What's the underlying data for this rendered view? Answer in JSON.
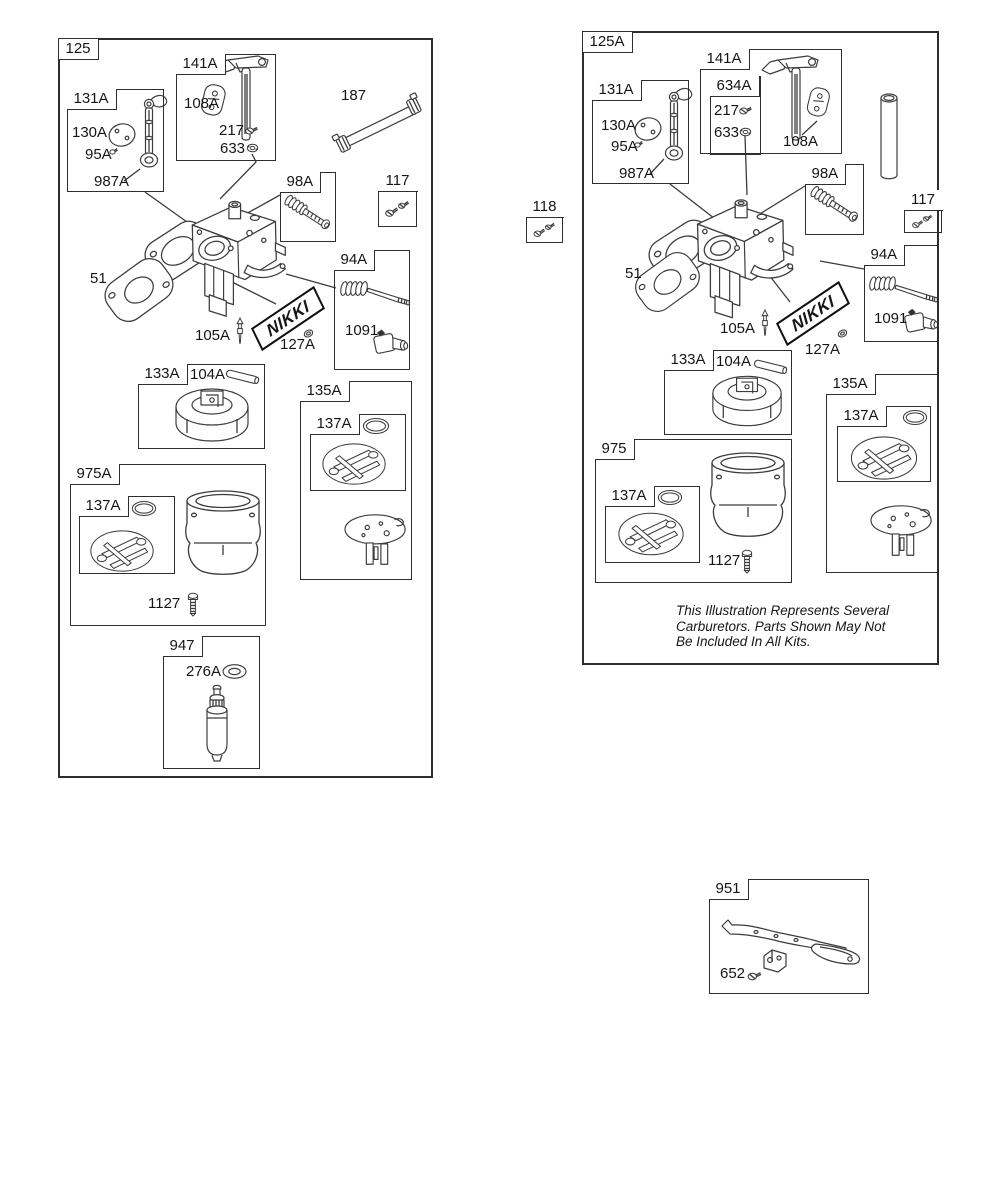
{
  "left_panel": {
    "ref": "125",
    "box_141A": {
      "ref": "141A",
      "part_108A": "108A",
      "part_217": "217",
      "part_633": "633"
    },
    "part_187": "187",
    "box_131A": {
      "ref": "131A",
      "part_130A": "130A",
      "part_95A": "95A",
      "part_987A": "987A"
    },
    "box_98A": {
      "ref": "98A"
    },
    "box_117": {
      "ref": "117"
    },
    "part_51": "51",
    "part_105A": "105A",
    "part_127A": "127A",
    "box_94A": {
      "ref": "94A",
      "part_1091": "1091"
    },
    "box_133A": {
      "ref": "133A",
      "part_104A": "104A"
    },
    "box_135A": {
      "ref": "135A",
      "box_137A": {
        "ref": "137A"
      }
    },
    "box_975A": {
      "ref": "975A",
      "box_137A": {
        "ref": "137A"
      },
      "part_1127": "1127"
    },
    "box_947": {
      "ref": "947",
      "part_276A": "276A"
    },
    "brand_logo": "NIKKI"
  },
  "right_panel": {
    "ref": "125A",
    "box_141A": {
      "ref": "141A",
      "part_108A": "108A",
      "box_634A": {
        "ref": "634A",
        "part_217": "217",
        "part_633": "633"
      }
    },
    "box_131A": {
      "ref": "131A",
      "part_130A": "130A",
      "part_95A": "95A",
      "part_987A": "987A"
    },
    "box_118": {
      "ref": "118"
    },
    "box_98A": {
      "ref": "98A"
    },
    "box_117": {
      "ref": "117"
    },
    "part_51": "51",
    "part_105A": "105A",
    "part_127A": "127A",
    "box_94A": {
      "ref": "94A",
      "part_1091": "1091"
    },
    "box_133A": {
      "ref": "133A",
      "part_104A": "104A"
    },
    "box_135A": {
      "ref": "135A",
      "box_137A": {
        "ref": "137A"
      }
    },
    "box_975": {
      "ref": "975",
      "box_137A": {
        "ref": "137A"
      },
      "part_1127": "1127"
    },
    "brand_logo": "NIKKI",
    "note": {
      "line1": "This Illustration Represents Several",
      "line2": "Carburetors. Parts Shown May Not",
      "line3": "Be Included In All Kits."
    }
  },
  "box_951": {
    "ref": "951",
    "part_652": "652"
  }
}
